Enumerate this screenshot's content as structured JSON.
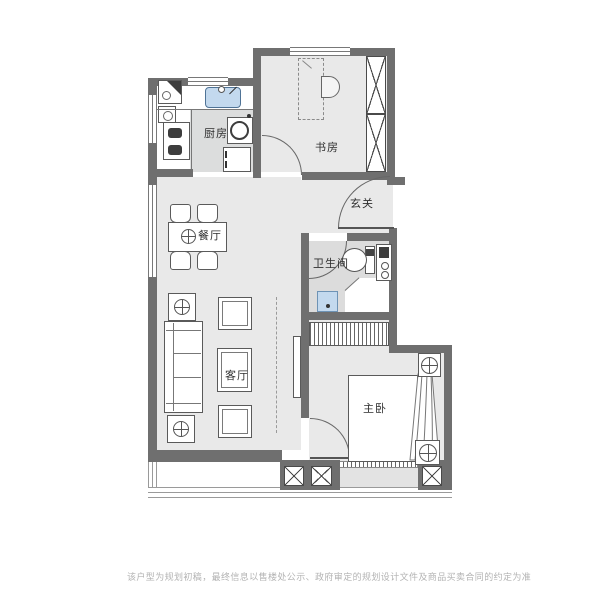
{
  "plan": {
    "rooms": {
      "kitchen": {
        "label": "厨房"
      },
      "study": {
        "label": "书房"
      },
      "entry": {
        "label": "玄关"
      },
      "dining": {
        "label": "餐厅"
      },
      "bathroom": {
        "label": "卫生间"
      },
      "living": {
        "label": "客厅"
      },
      "bedroom": {
        "label": "主卧"
      }
    },
    "fixtures": [
      "corner-cabinet",
      "gas-meter",
      "kitchen-sink",
      "gas-stove",
      "washing-machine",
      "refrigerator",
      "desk",
      "desk-chair",
      "wardrobe-study",
      "entry-door",
      "study-door",
      "bathroom-door",
      "bedroom-door",
      "toilet",
      "vanity-basin",
      "shower-tray",
      "shower-stall",
      "dining-table",
      "dining-chair",
      "table-centerpiece",
      "lamp-table",
      "sofa",
      "coffee-table",
      "stool",
      "tv",
      "wardrobe-bedroom",
      "bed",
      "nightstand",
      "curtain-drape",
      "structural-column",
      "window",
      "balcony-railing",
      "bay-window"
    ],
    "colors": {
      "wall": "#6f6f6f",
      "floor": "#e9e9e9",
      "bathroom_floor": "#dcdcdc",
      "counter_gray": "#dcdddd",
      "fixture_blue": "#c3d9ee",
      "outline": "#555555",
      "disclaimer_text": "#b3b3b3"
    },
    "disclaimer": "该户型为规划初稿，最终信息以售楼处公示、政府审定的规划设计文件及商品买卖合同的约定为准"
  }
}
